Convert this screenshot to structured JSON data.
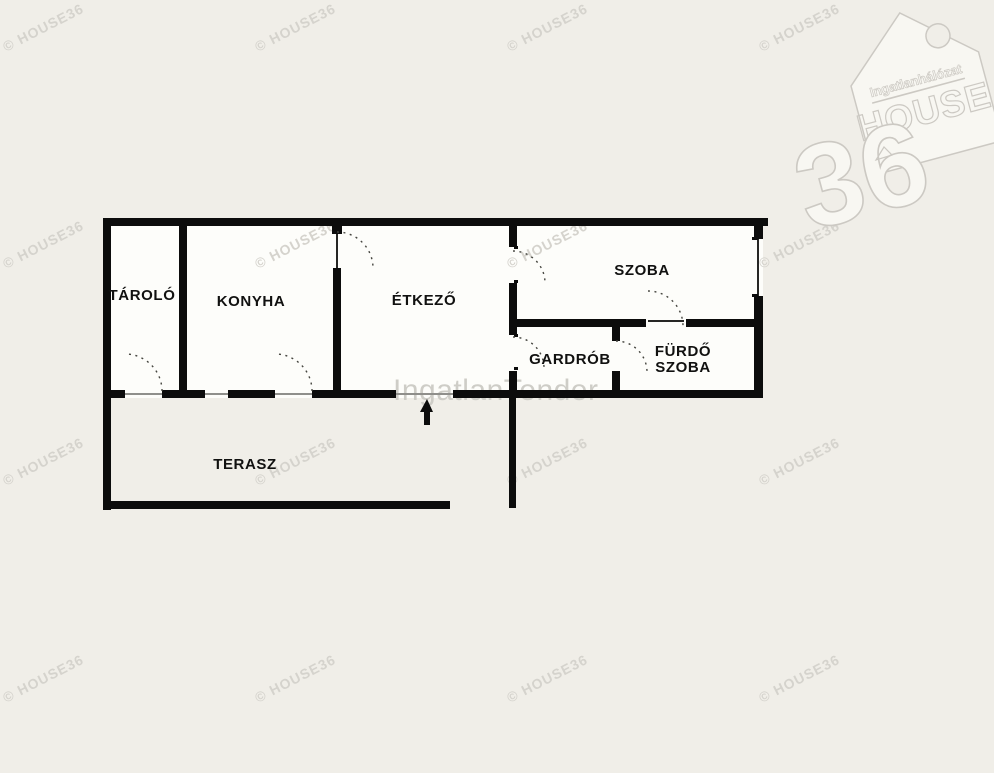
{
  "page": {
    "background_color": "#f0eee8"
  },
  "logo": {
    "name": "HOUSE36 real-estate network tag logo",
    "brand": "Ingatlanhálózat",
    "house": "HOUSE",
    "number": "36",
    "outline_color": "#ccc9c3",
    "fill_color": "#f8f7f2"
  },
  "watermark": {
    "tile_text": "© HOUSE36",
    "tile_color": "#d5d3cd",
    "center_text": "IngatlanTender",
    "center_color": "#cecdc7"
  },
  "floorplan": {
    "wall_color": "#0c0c0c",
    "floor_color": "#fdfdfa",
    "rooms": [
      {
        "id": "tarolo",
        "label": "TÁROLÓ"
      },
      {
        "id": "konyha",
        "label": "KONYHA"
      },
      {
        "id": "etkezo",
        "label": "ÉTKEZŐ"
      },
      {
        "id": "szoba",
        "label": "SZOBA"
      },
      {
        "id": "gardrob",
        "label": "GARDRÓB"
      },
      {
        "id": "furdoszoba",
        "label": "FÜRDŐ SZOBA",
        "line1": "FÜRDŐ",
        "line2": "SZOBA"
      },
      {
        "id": "terasz",
        "label": "TERASZ"
      }
    ],
    "icons": {
      "entrance_arrow": "up-arrow",
      "door_swings": "dashed-quarter-arc",
      "logo_hole": "tag-hole-circle"
    }
  }
}
